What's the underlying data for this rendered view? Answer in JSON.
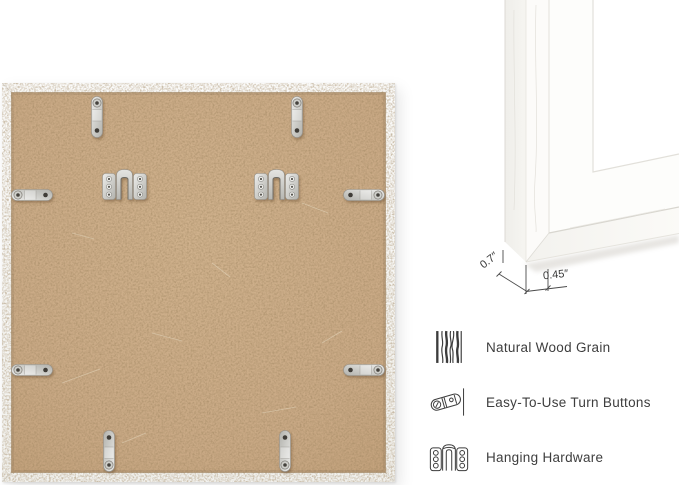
{
  "page": {
    "background_color": "#ffffff"
  },
  "back_view": {
    "backing_color": "#c9a985",
    "frame_color": "#f8f8f6",
    "hardware": {
      "metal_color": "#d6d5d1",
      "turn_button_count": 8,
      "hanging_hardware_count": 2
    }
  },
  "corner_view": {
    "dimensions": {
      "depth_label": "0.7″",
      "face_width_label": "0.45″"
    }
  },
  "features": {
    "text_color": "#3e3e3e",
    "items": [
      {
        "icon": "wood-grain-icon",
        "label": "Natural Wood Grain"
      },
      {
        "icon": "turn-button-icon",
        "label": "Easy-To-Use Turn Buttons"
      },
      {
        "icon": "hanging-hardware-icon",
        "label": "Hanging Hardware"
      }
    ]
  }
}
